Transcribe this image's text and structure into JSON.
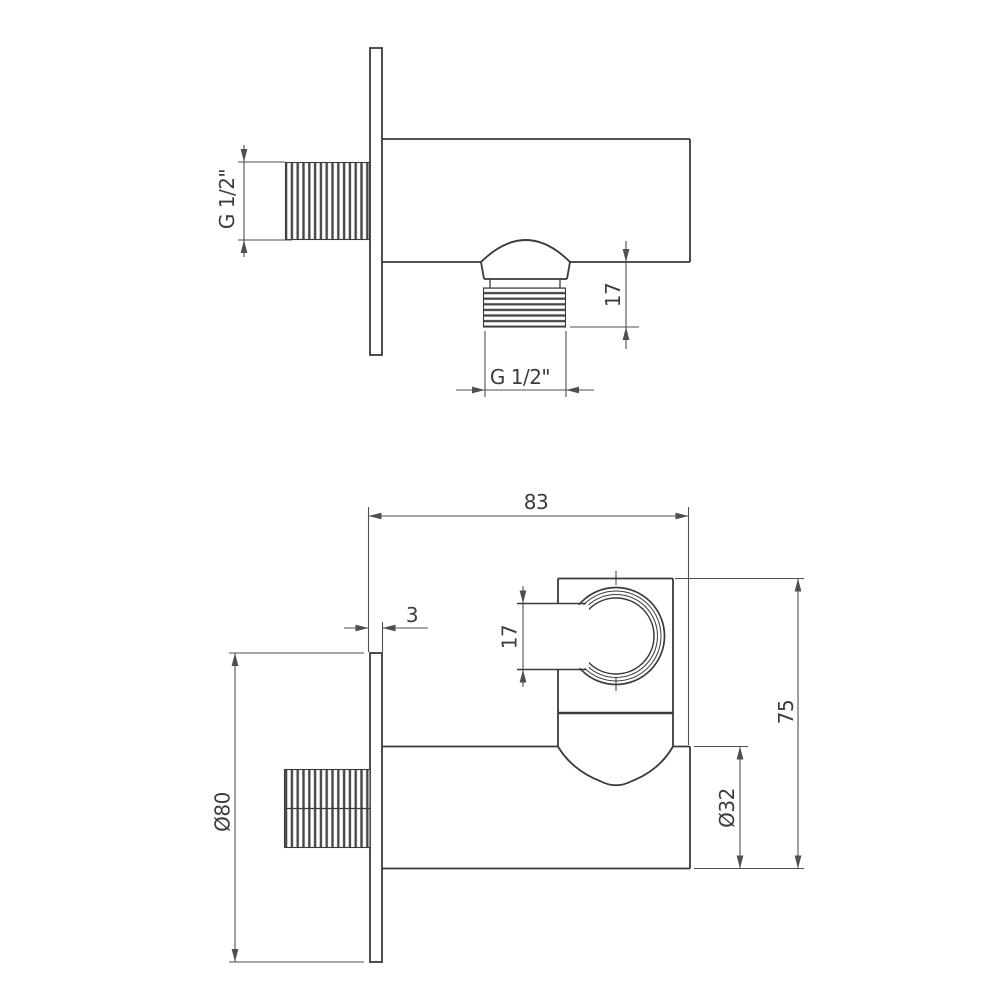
{
  "colors": {
    "background": "#ffffff",
    "outline": "#3a3a3a",
    "dimension_line": "#4f4f4f",
    "thread_hatch": "#474747"
  },
  "side_view": {
    "labels": {
      "inlet_thread": "G 1/2\"",
      "outlet_depth": "17",
      "outlet_thread": "G 1/2\""
    }
  },
  "front_view": {
    "labels": {
      "width": "83",
      "plate_thickness": "3",
      "holder_slot_height": "17",
      "total_height": "75",
      "body_diameter": "Ø32",
      "flange_diameter": "Ø80"
    }
  }
}
